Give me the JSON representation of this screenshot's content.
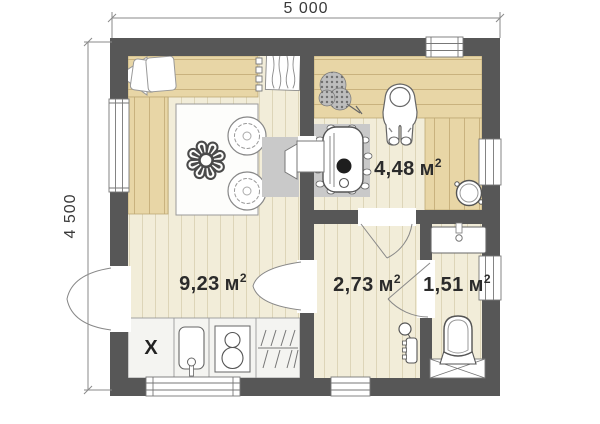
{
  "plan": {
    "dimension_width": "5 000",
    "dimension_height": "4 500",
    "rooms": [
      {
        "name": "living-kitchen",
        "area": "9,23",
        "unit": "м",
        "sup": "2"
      },
      {
        "name": "sauna",
        "area": "4,48",
        "unit": "м",
        "sup": "2"
      },
      {
        "name": "shower-room",
        "area": "2,73",
        "unit": "м",
        "sup": "2"
      },
      {
        "name": "toilet",
        "area": "1,51",
        "unit": "м",
        "sup": "2"
      }
    ],
    "kitchen_marker": "X",
    "icons": {
      "table-flowers": "❁"
    },
    "colors": {
      "wall": "#575757",
      "floor": "#f2edd9",
      "floor_line": "#ddd5b8",
      "wood": "#e8d6a6",
      "wood_line": "#c9b27e",
      "pad": "#c9c9c9",
      "text": "#2d2d2d"
    }
  }
}
